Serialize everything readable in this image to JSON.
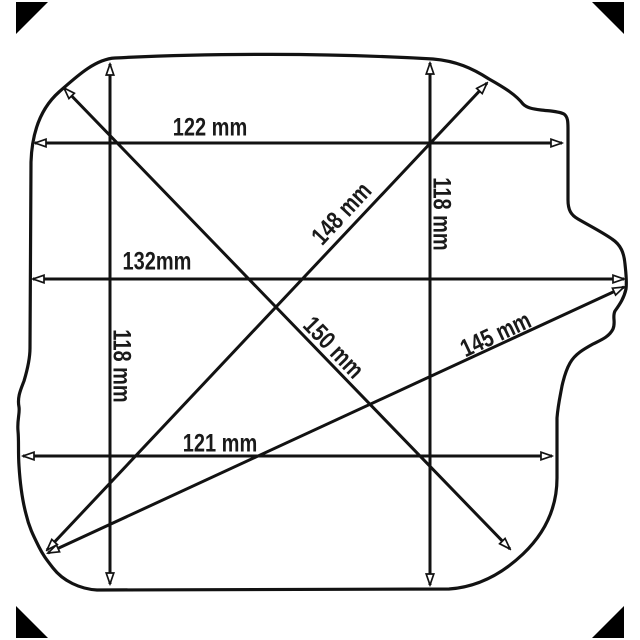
{
  "diagram": {
    "unit": "mm",
    "labels": {
      "width_top": "122 mm",
      "width_middle": "132mm",
      "width_bottom": "121 mm",
      "height_left": "118 mm",
      "height_right": "118 mm",
      "diagonal_148": "148 mm",
      "diagonal_150": "150 mm",
      "diagonal_145": "145 mm"
    },
    "measurements_mm": {
      "top_width": 122,
      "middle_width": 132,
      "bottom_width": 121,
      "left_height": 118,
      "right_height": 118,
      "diagonal_a": 148,
      "diagonal_b": 150,
      "diagonal_c": 145
    },
    "colors": {
      "background": "#ffffff",
      "line": "#121212",
      "text": "#1a1a1a",
      "corner_marks": "#000000"
    }
  }
}
